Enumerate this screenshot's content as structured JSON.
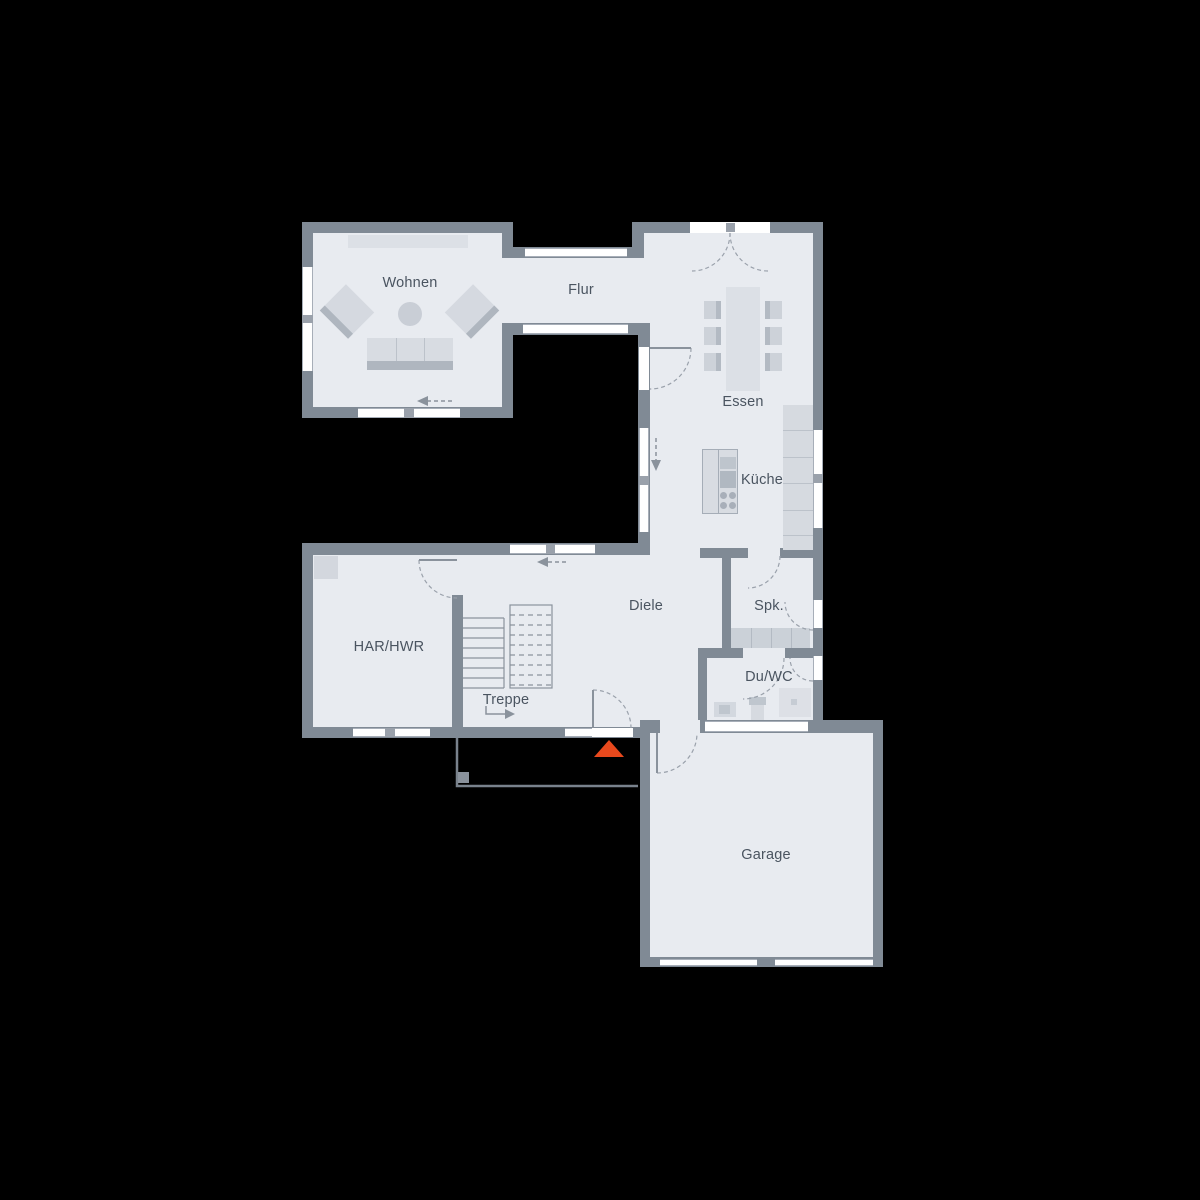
{
  "plan": {
    "type": "floor-plan",
    "rooms": {
      "wohnen": {
        "label": "Wohnen"
      },
      "flur": {
        "label": "Flur"
      },
      "essen": {
        "label": "Essen"
      },
      "kueche": {
        "label": "Küche"
      },
      "diele": {
        "label": "Diele"
      },
      "spk": {
        "label": "Spk."
      },
      "har_hwr": {
        "label": "HAR/HWR"
      },
      "treppe": {
        "label": "Treppe"
      },
      "du_wc": {
        "label": "Du/WC"
      },
      "garage": {
        "label": "Garage"
      }
    },
    "colors": {
      "background": "#000000",
      "wall": "#808A95",
      "floor": "#E8EBF0",
      "window": "#FFFFFF",
      "furniture_light": "#D8DCE2",
      "furniture_dark": "#AFB6BF",
      "entrance_marker": "#E8491D",
      "label_text": "#4A5460"
    }
  }
}
